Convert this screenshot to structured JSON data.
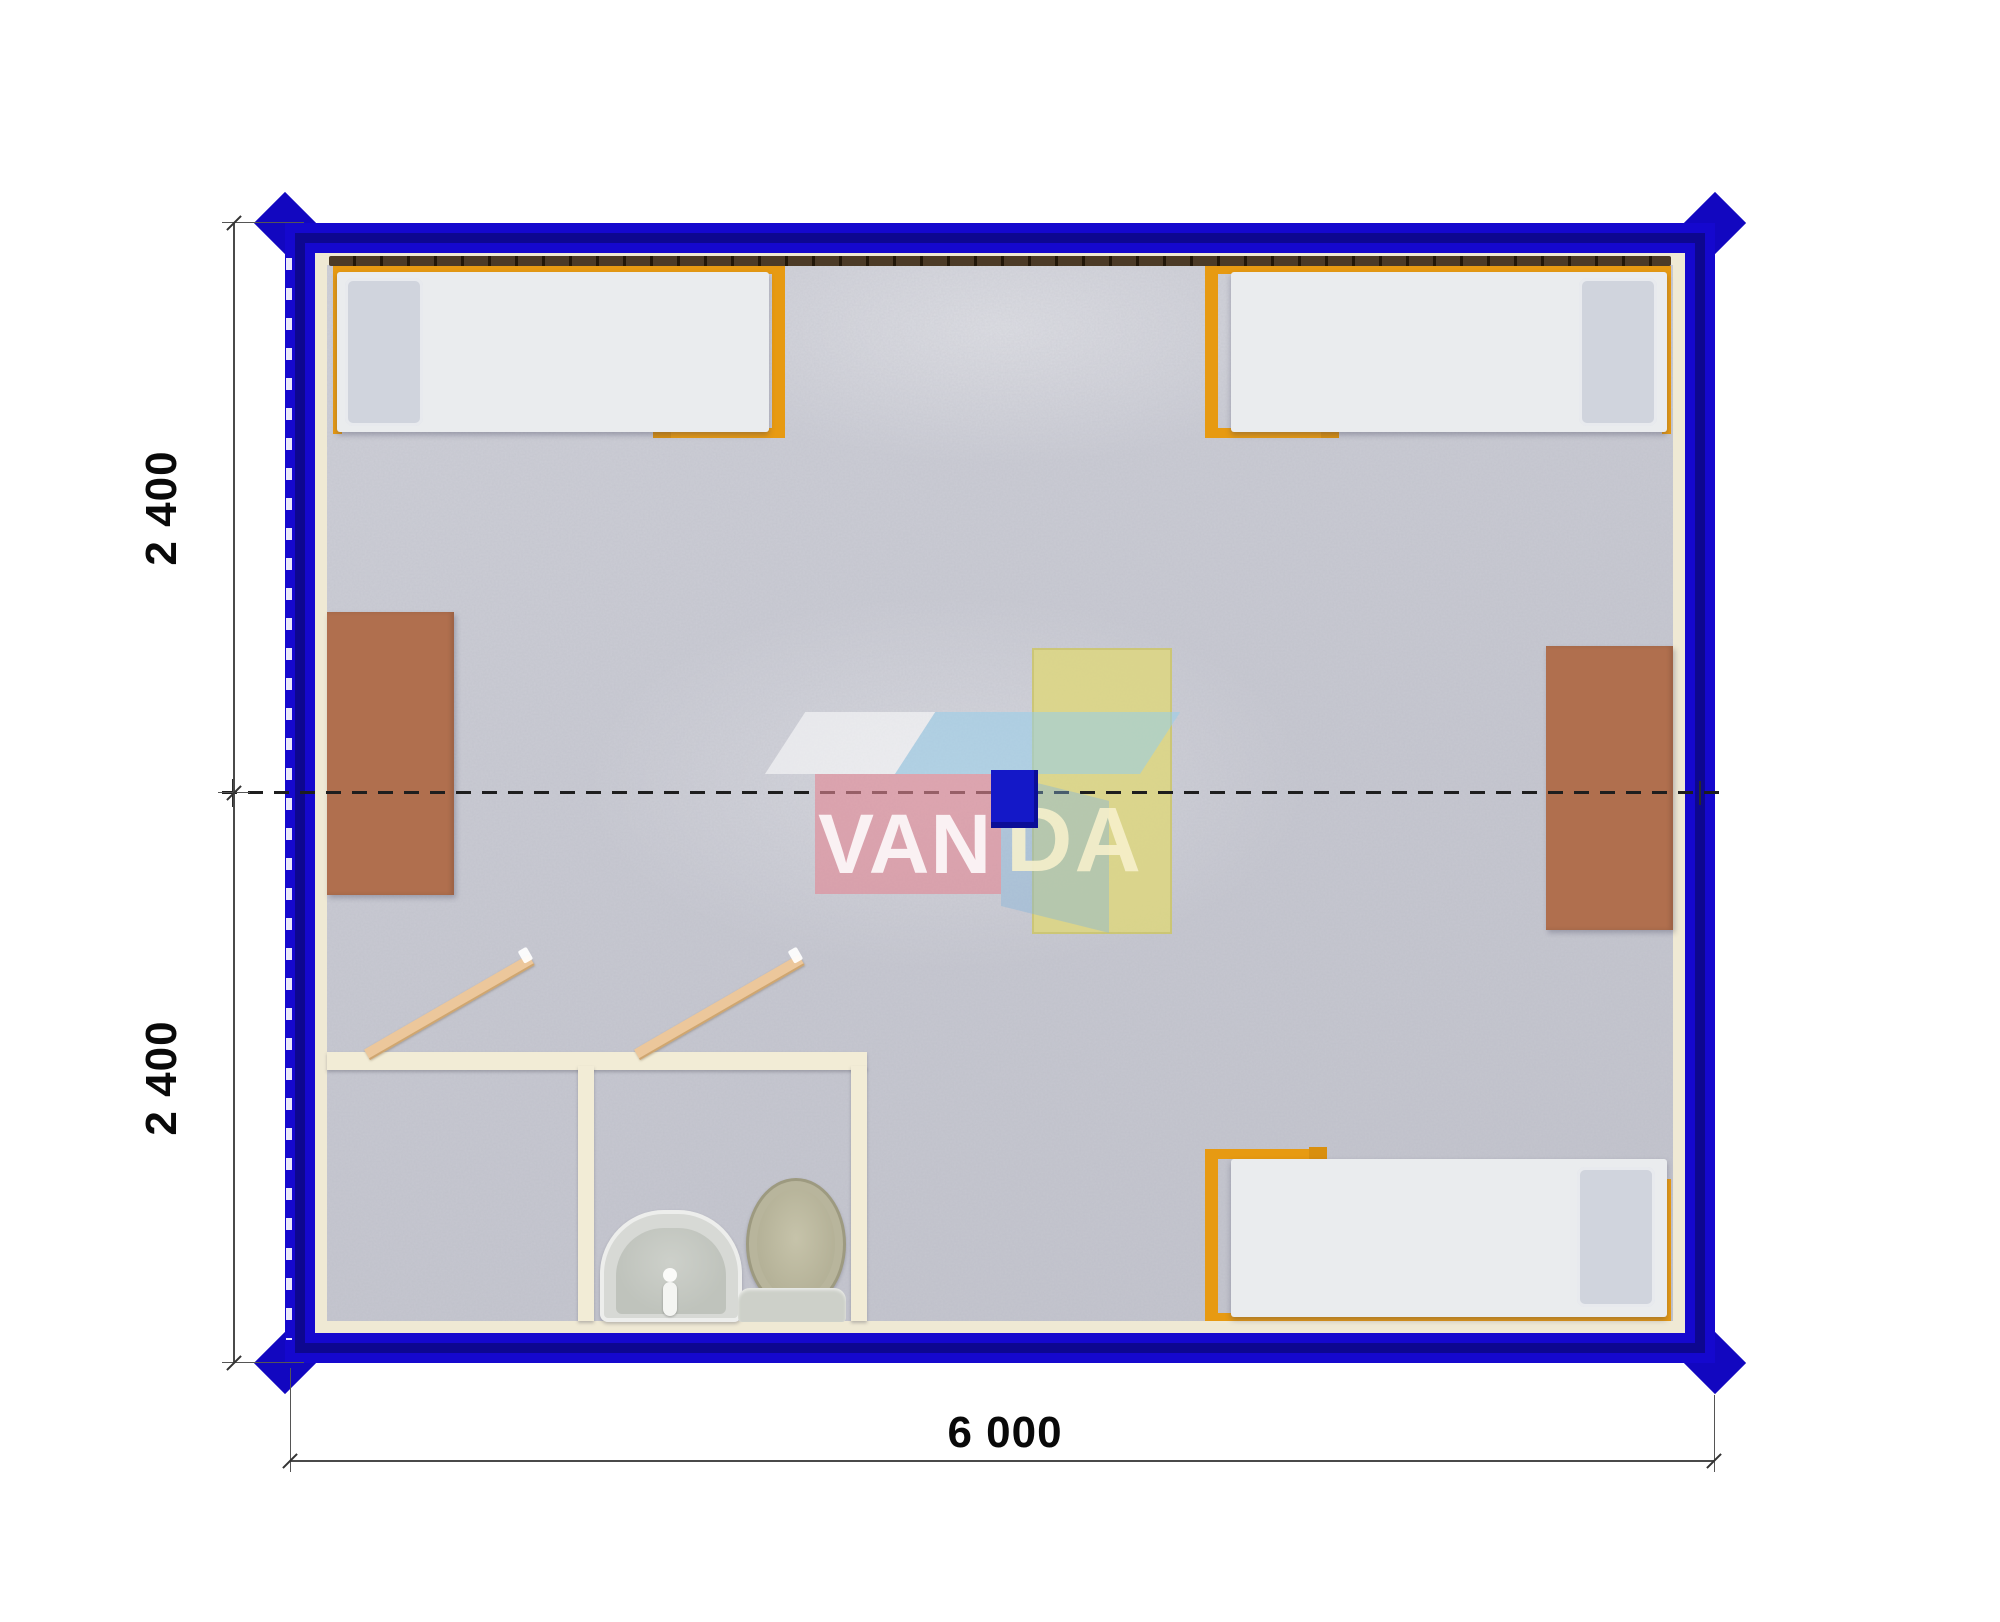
{
  "plan": {
    "type": "container-floor-plan",
    "modules": 2,
    "dimension_labels": {
      "left_top": "2 400",
      "left_bottom": "2 400",
      "bottom": "6 000"
    },
    "watermark": {
      "left": "VAN",
      "right": "DA"
    },
    "colors": {
      "frame_blue": "#1508ce",
      "frame_inner_navy": "#0d0790",
      "wall_lining_cream": "#efe9d4",
      "floor_gray": "#c9cad2",
      "bed_frame_orange": "#e79a12",
      "mattress_white": "#eaecee",
      "pillow_gray": "#d3d6dc",
      "table_brown": "#b06f4e",
      "table_yellow": "#ddd77e",
      "bathroom_wall_cream": "#f2ecd6",
      "door_tan": "#ecc79b",
      "fixture_gray": "#d7d9d5",
      "toilet_lid_khaki": "#b8b59c",
      "logo_pink": "#e28794",
      "logo_light_blue": "#96cbe4",
      "logo_square_blue": "#1418c8",
      "dimension_line": "#4a4a4a"
    },
    "furniture": [
      {
        "name": "bed",
        "position": "top-left"
      },
      {
        "name": "bed",
        "position": "top-right"
      },
      {
        "name": "bed",
        "position": "bottom-right"
      },
      {
        "name": "desk",
        "position": "left-wall"
      },
      {
        "name": "desk",
        "position": "right-wall"
      },
      {
        "name": "table",
        "position": "center"
      },
      {
        "name": "sink",
        "position": "bathroom"
      },
      {
        "name": "toilet",
        "position": "bathroom"
      },
      {
        "name": "door",
        "position": "bathroom-left"
      },
      {
        "name": "door",
        "position": "bathroom-right"
      }
    ]
  }
}
